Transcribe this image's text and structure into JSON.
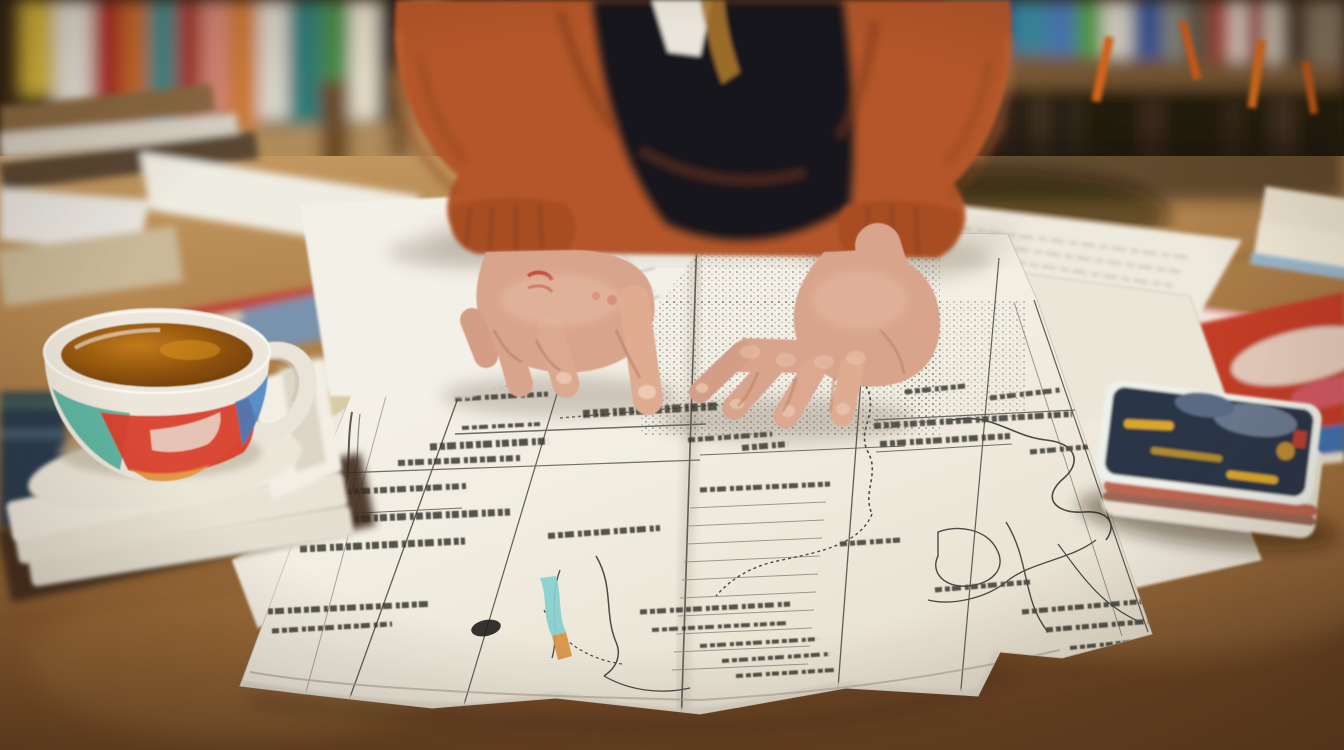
{
  "scene": {
    "kind": "photograph",
    "description": "Person in a rust-orange hoodie seated at a cluttered study desk, both hands resting on a large unfolded map covered in fine illegible print, a painted tea cup on a stack of papers at left, blurred bookshelves behind, and books, printed pages and a small dark card deck on the warm wooden desk at right.",
    "objects": {
      "bookshelf": {
        "label": "blurred bookshelves with colorful book spines and orange ribbon markers"
      },
      "person": {
        "label": "person in rust-orange hoodie over a black shirt with white collar"
      },
      "left_hand": {
        "label": "left hand with a small red ring, index finger touching the map"
      },
      "right_hand": {
        "label": "right hand with spread fingers resting on the map"
      },
      "map": {
        "label": "large unfolded map with column lines, table rows, rivers and dense fine print"
      },
      "river_highlight": {
        "label": "small teal-highlighted river with orange tip"
      },
      "cup": {
        "label": "white tea cup with red, teal and blue abstract band, amber tea inside"
      },
      "cup_stack": {
        "label": "stack of white papers and a dark tray under the cup"
      },
      "left_stack": {
        "label": "pile of books, magazines and folded beige papers at left"
      },
      "sketch_paper": {
        "label": "sheet with faint pencil sketches overlapping the map"
      },
      "side_papers": {
        "label": "slanted printed pages and a pink-edged folder at right"
      },
      "red_book": {
        "label": "red book with white swoosh on a blue book at right edge"
      },
      "card_deck": {
        "label": "small deck of dark navy patterned cards with yellow streaks"
      },
      "desk": {
        "label": "warm wooden desk surface"
      }
    },
    "palette": {
      "hoodie": "#b4572a",
      "hoodie_shadow": "#7e3a1a",
      "hoodie_highlight": "#cf7040",
      "shirt": "#16171b",
      "collar": "#e9e5da",
      "lining_gold": "#a8762f",
      "skin": "#d9a48c",
      "skin_light": "#eec9b2",
      "skin_shadow": "#bb8166",
      "ring_red": "#c0392b",
      "paper": "#f5f2ea",
      "paper_warm": "#e9e2d2",
      "ink": "#30302c",
      "teal_river": "#86cfcf",
      "river_tip_orange": "#d9913f",
      "wood": "#a87944",
      "wood_dark": "#6b4423",
      "cup_red": "#d93f2b",
      "cup_teal": "#4fae9b",
      "cup_blue": "#3f7fc1",
      "tea": "#a35f0e",
      "card_navy": "#2b3647",
      "card_yellow": "#d9a82a",
      "folder_pink": "#e2aeb2",
      "book_red": "#c23c28",
      "book_blue": "#3f6fae"
    }
  }
}
